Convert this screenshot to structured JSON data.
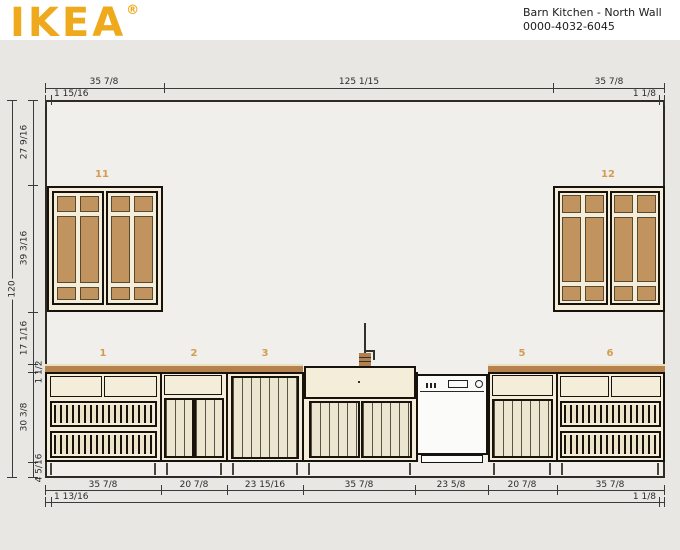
{
  "header": {
    "logo_text": "IKEA",
    "registered_mark": "®",
    "project_title": "Barn Kitchen - North Wall",
    "project_id": "0000-4032-6045"
  },
  "dimensions": {
    "top": {
      "segments": [
        "35 7/8",
        "125 1/15",
        "35 7/8"
      ],
      "sub_left": "1 15/16",
      "sub_right": "1 1/8"
    },
    "left": {
      "overall": "120",
      "segments": [
        "27 9/16",
        "39 3/16",
        "17 1/16",
        "1 1/2",
        "30 3/8",
        "4 5/16"
      ]
    },
    "bottom": {
      "segments": [
        "35 7/8",
        "20 7/8",
        "23 15/16",
        "35 7/8",
        "23 5/8",
        "20 7/8",
        "35 7/8"
      ],
      "sub_left": "1 13/16",
      "sub_right": "1 1/8"
    }
  },
  "item_labels": {
    "wall_cabinet_left": "11",
    "wall_cabinet_right": "12",
    "base_cabinet_1": "1",
    "base_cabinet_2": "2",
    "base_cabinet_3": "3",
    "base_cabinet_5": "5",
    "base_cabinet_6": "6"
  },
  "colors": {
    "logo_yellow": "#efa91d",
    "label_orange": "#d29c52",
    "countertop_brown": "#b5814d",
    "cabinet_cream": "#f3edda",
    "glass_pane_brown": "#c0935f",
    "drawing_background": "#e8e7e3",
    "wall_face": "#f0efeb"
  }
}
